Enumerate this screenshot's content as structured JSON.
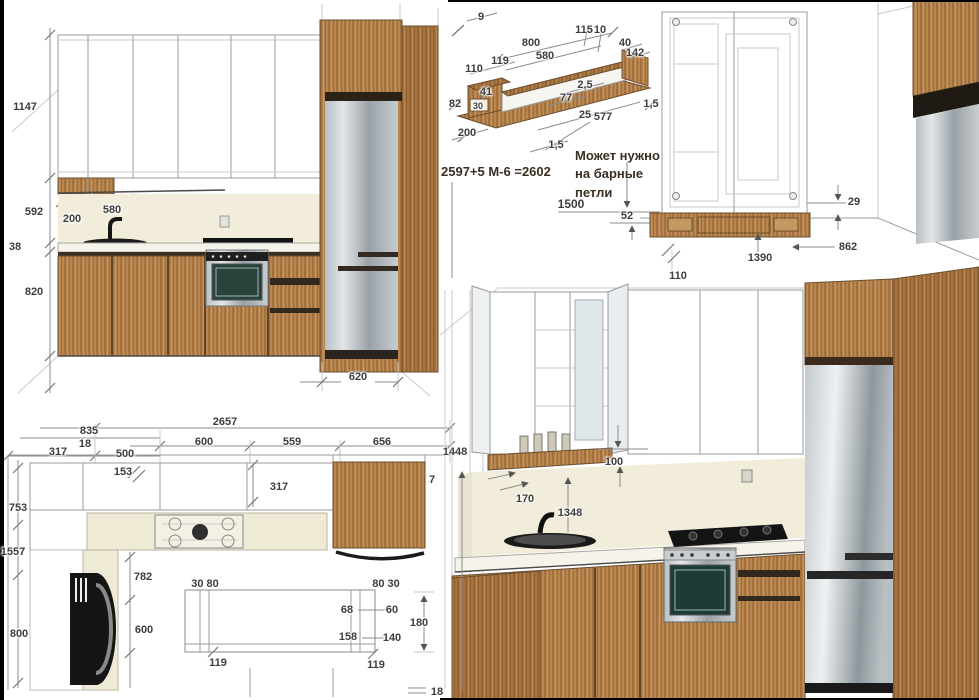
{
  "colors": {
    "wood": "#b5834e",
    "wood_dark": "#a2713f",
    "steel": "#b9bfc3",
    "cream_backsplash": "#f1edda",
    "counter": "#f6f4ea",
    "drawing_line": "#9b9b9b",
    "dim_text": "#3d3d3d",
    "note_text": "#3a2f23",
    "appliance_black": "#141414"
  },
  "panels": {
    "front_elevation": {
      "labels": [
        {
          "t": "1147",
          "x": 25,
          "y": 107
        },
        {
          "t": "592",
          "x": 34,
          "y": 212
        },
        {
          "t": "38",
          "x": 15,
          "y": 247
        },
        {
          "t": "820",
          "x": 34,
          "y": 292
        },
        {
          "t": "580",
          "x": 112,
          "y": 210
        },
        {
          "t": "200",
          "x": 72,
          "y": 219
        },
        {
          "t": "620",
          "x": 358,
          "y": 377
        }
      ]
    },
    "shelf_detail": {
      "formula": "2597+5 М-6 =2602",
      "note_lines": [
        "Может нужно",
        "на барные",
        "петли"
      ],
      "labels": [
        {
          "t": "9",
          "x": 481,
          "y": 17
        },
        {
          "t": "800",
          "x": 531,
          "y": 43
        },
        {
          "t": "580",
          "x": 545,
          "y": 56
        },
        {
          "t": "119",
          "x": 500,
          "y": 61
        },
        {
          "t": "110",
          "x": 474,
          "y": 69
        },
        {
          "t": "115",
          "x": 584,
          "y": 30
        },
        {
          "t": "10",
          "x": 600,
          "y": 30
        },
        {
          "t": "40",
          "x": 625,
          "y": 43
        },
        {
          "t": "142",
          "x": 635,
          "y": 53
        },
        {
          "t": "2,5",
          "x": 585,
          "y": 85
        },
        {
          "t": "77",
          "x": 566,
          "y": 98
        },
        {
          "t": "41",
          "x": 486,
          "y": 92
        },
        {
          "t": "30",
          "x": 478,
          "y": 106,
          "s": 9
        },
        {
          "t": "82",
          "x": 455,
          "y": 104
        },
        {
          "t": "25",
          "x": 585,
          "y": 115
        },
        {
          "t": "577",
          "x": 603,
          "y": 117
        },
        {
          "t": "1,5",
          "x": 651,
          "y": 104
        },
        {
          "t": "200",
          "x": 467,
          "y": 133
        },
        {
          "t": "1,5",
          "x": 556,
          "y": 145
        },
        {
          "t": "1500",
          "x": 571,
          "y": 204,
          "s": 12
        },
        {
          "t": "52",
          "x": 627,
          "y": 216
        }
      ]
    },
    "cabinet_detail": {
      "labels": [
        {
          "t": "29",
          "x": 854,
          "y": 202
        },
        {
          "t": "862",
          "x": 848,
          "y": 247
        },
        {
          "t": "1390",
          "x": 760,
          "y": 258
        },
        {
          "t": "110",
          "x": 678,
          "y": 276
        }
      ]
    },
    "plan_view": {
      "labels": [
        {
          "t": "2657",
          "x": 225,
          "y": 422
        },
        {
          "t": "835",
          "x": 89,
          "y": 431
        },
        {
          "t": "18",
          "x": 85,
          "y": 444
        },
        {
          "t": "600",
          "x": 204,
          "y": 442
        },
        {
          "t": "559",
          "x": 292,
          "y": 442
        },
        {
          "t": "656",
          "x": 382,
          "y": 442
        },
        {
          "t": "317",
          "x": 58,
          "y": 452
        },
        {
          "t": "500",
          "x": 125,
          "y": 454
        },
        {
          "t": "153",
          "x": 123,
          "y": 472
        },
        {
          "t": "317",
          "x": 279,
          "y": 487
        },
        {
          "t": "1448",
          "x": 455,
          "y": 452
        },
        {
          "t": "7",
          "x": 432,
          "y": 480
        },
        {
          "t": "753",
          "x": 18,
          "y": 508
        },
        {
          "t": "1557",
          "x": 13,
          "y": 552
        },
        {
          "t": "800",
          "x": 19,
          "y": 634
        },
        {
          "t": "782",
          "x": 143,
          "y": 577
        },
        {
          "t": "600",
          "x": 144,
          "y": 630
        },
        {
          "t": "30 80",
          "x": 205,
          "y": 584
        },
        {
          "t": "80 30",
          "x": 386,
          "y": 584
        },
        {
          "t": "68",
          "x": 347,
          "y": 610
        },
        {
          "t": "60",
          "x": 392,
          "y": 610
        },
        {
          "t": "158",
          "x": 348,
          "y": 637
        },
        {
          "t": "140",
          "x": 392,
          "y": 638
        },
        {
          "t": "180",
          "x": 419,
          "y": 623
        },
        {
          "t": "119",
          "x": 218,
          "y": 663
        },
        {
          "t": "119",
          "x": 376,
          "y": 665
        },
        {
          "t": "18",
          "x": 437,
          "y": 692
        }
      ]
    },
    "perspective_view": {
      "labels": [
        {
          "t": "100",
          "x": 614,
          "y": 462
        },
        {
          "t": "170",
          "x": 525,
          "y": 499
        },
        {
          "t": "1348",
          "x": 570,
          "y": 513
        }
      ]
    }
  }
}
